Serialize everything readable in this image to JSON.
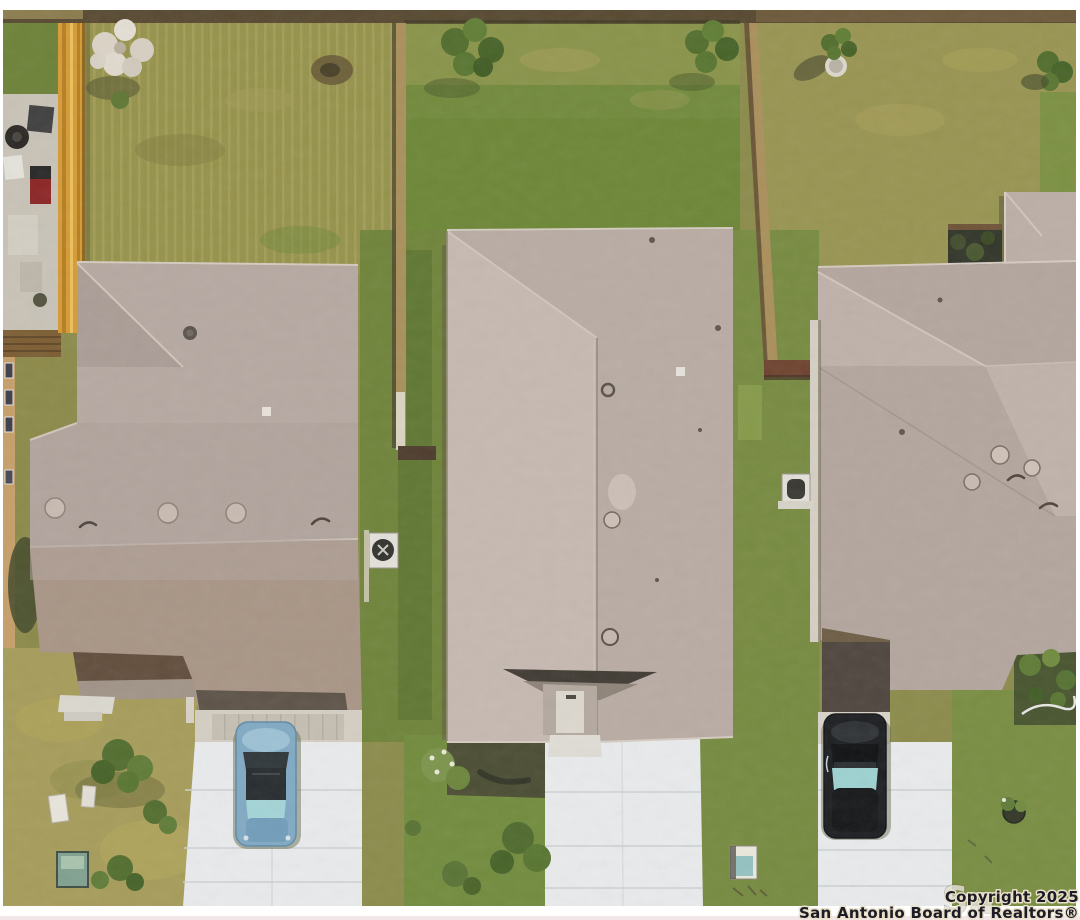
{
  "image": {
    "type": "aerial-real-estate-photo",
    "description": "Overhead drone view of three suburban houses with gray-tan shingle roofs, fenced backyards, green and dry lawns, white concrete driveways with two parked cars (one blue, one black)"
  },
  "watermark": {
    "logo_partial": "Sa",
    "line1": "Copyright 2025",
    "line2": "San Antonio Board of Realtors®"
  },
  "palette": {
    "page_bg": "#ffffff",
    "grass_base": "#8a8a48",
    "grass_green": "#6f8838",
    "grass_bright": "#74893c",
    "grass_dry": "#a59b57",
    "roof_left_house": "#b6a8a1",
    "roof_center_west": "#c6b9b1",
    "roof_center_east": "#b9aba3",
    "roof_right_house": "#b3a59d",
    "roof_front_brown": "#a89484",
    "driveway": "#eaecee",
    "fence_yellow": "#d79a2f",
    "fence_wood": "#a98e58",
    "car_blue": "#7fa9c4",
    "car_black": "#17191c",
    "car_glass_teal": "#9cd3d2",
    "utility_box_green": "#7fa08e",
    "watermark_text": "#1c1b26",
    "watermark_glow": "#e8e0c8",
    "watermark_logo": "#e3e0d8"
  }
}
